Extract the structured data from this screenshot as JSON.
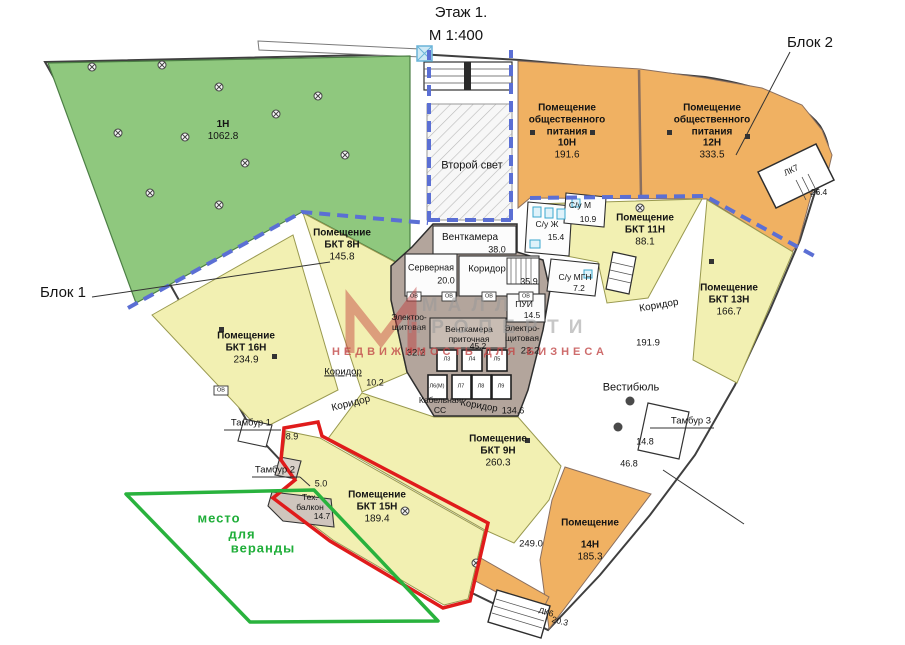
{
  "title": {
    "floor": "Этаж 1.",
    "scale": "М 1:400"
  },
  "blocks": {
    "block1": "Блок 1",
    "block2": "Блок 2"
  },
  "watermark": {
    "line1": "МАЛЛ",
    "line2": "ПРОПЕРТИ",
    "line3": "НЕДВИЖИМОСТЬ ДЛЯ БИЗНЕСА"
  },
  "veranda": {
    "line1": "место",
    "line2": "для",
    "line3": "веранды"
  },
  "rooms": {
    "r1n": {
      "name": "1Н",
      "area": "1062.8"
    },
    "r10n": {
      "t1": "Помещение",
      "t2": "общественного",
      "t3": "питания",
      "name": "10Н",
      "area": "191.6"
    },
    "r12n": {
      "t1": "Помещение",
      "t2": "общественного",
      "t3": "питания",
      "name": "12Н",
      "area": "333.5"
    },
    "bkt8n": {
      "t": "Помещение",
      "name": "БКТ 8Н",
      "area": "145.8"
    },
    "bkt9n": {
      "t": "Помещение",
      "name": "БКТ 9Н",
      "area": "260.3"
    },
    "bkt11n": {
      "t": "Помещение",
      "name": "БКТ 11Н",
      "area": "88.1"
    },
    "bkt13n": {
      "t": "Помещение",
      "name": "БКТ 13Н",
      "area": "166.7"
    },
    "bkt15n": {
      "t": "Помещение",
      "name": "БКТ 15Н",
      "area": "189.4"
    },
    "bkt16n": {
      "t": "Помещение",
      "name": "БКТ 16Н",
      "area": "234.9"
    },
    "r14n": {
      "t": "Помещение",
      "name": "14Н",
      "area": "185.3"
    },
    "vtoroy_svet": "Второй свет",
    "ventkamera": {
      "name": "Венткамера",
      "area": "38.0"
    },
    "servernaya": {
      "name": "Серверная",
      "area": "20.0"
    },
    "koridor_core": {
      "name": "Коридор",
      "area": "35.9"
    },
    "su_zh": {
      "name": "С/у Ж",
      "area": "15.4"
    },
    "su_m": {
      "name": "С/у М",
      "area": "10.9"
    },
    "su_mgn": {
      "name": "С/у МГН",
      "area": "7.2"
    },
    "pui": {
      "name": "ПУИ",
      "area": "14.5"
    },
    "electro1": {
      "n1": "Электро-",
      "n2": "щитовая",
      "area": "32.2"
    },
    "ventpritok": {
      "n1": "Венткамера",
      "n2": "приточная",
      "area": "45.2"
    },
    "electro2": {
      "n1": "Электро-",
      "n2": "щитовая",
      "area": "23.2"
    },
    "cable": {
      "n1": "Кабельная",
      "n2": "СС"
    },
    "koridor_lift": {
      "name": "Коридор",
      "area": "134.6"
    },
    "koridor_left": {
      "name": "Коридор",
      "area": "10.2"
    },
    "koridor_left2": "Коридор",
    "koridor_right": {
      "name": "Коридор",
      "area": "191.9"
    },
    "vestibul": "Вестибюль",
    "tambur1": {
      "name": "Тамбур 1",
      "area": "8.9"
    },
    "tambur2": {
      "name": "Тамбур 2",
      "area": "5.0"
    },
    "tambur3": "Тамбур 3",
    "tech_balkon": {
      "n1": "Тех.",
      "n2": "балкон",
      "area": "14.7"
    },
    "lk6": {
      "name": "ЛК6",
      "area": "20.3"
    },
    "lk7": {
      "name": "ЛК7",
      "area": "26.4"
    },
    "area_14_8": "14.8",
    "area_46_8": "46.8",
    "area_249": "249.0"
  },
  "elevators": [
    "Л3",
    "Л4",
    "Л5",
    "Л6(М)",
    "Л7",
    "Л8",
    "Л9"
  ],
  "fixtures": {
    "ov": "ОВ"
  },
  "colors": {
    "green": "#8fc87e",
    "yellow": "#f2f0b2",
    "orange": "#f0b162",
    "core": "#b3a59c",
    "dash_blue": "#5b6fd4",
    "highlight_red": "#e01b1b",
    "veranda_green": "#29b23d"
  }
}
